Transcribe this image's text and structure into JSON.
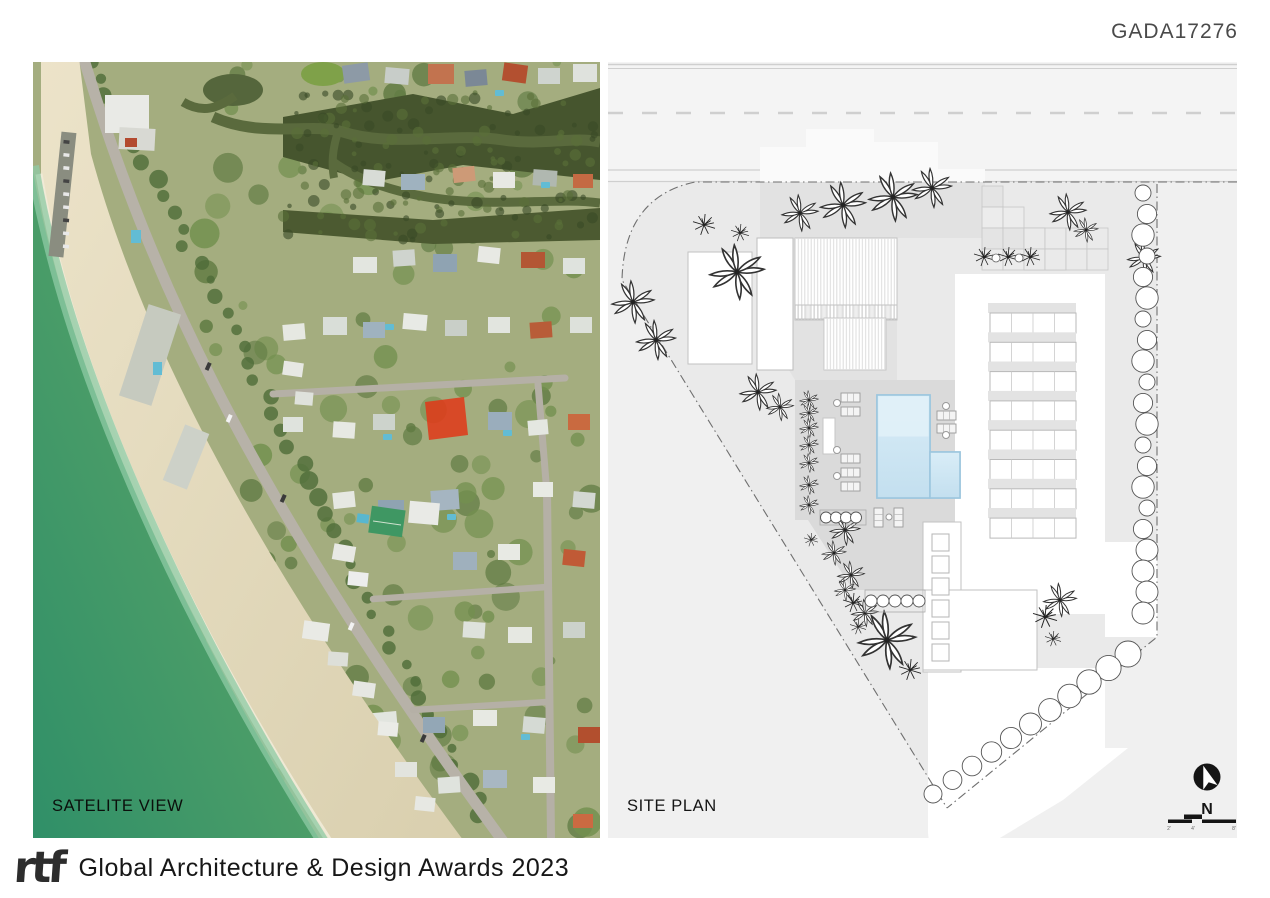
{
  "header": {
    "code": "GADA17276"
  },
  "satellite": {
    "label": "SATELITE VIEW",
    "colors": {
      "ocean_deep": "#2f8f68",
      "ocean_mid": "#4f9f68",
      "ocean_shallow": "#9ed2b2",
      "sand": "#e4dabc",
      "vegetation": "#77914f",
      "mangrove": "#46552e",
      "channel_water": "#5a6a3d",
      "road": "#b7b2a8",
      "site_highlight": "#e23718"
    }
  },
  "site_plan": {
    "label": "SITE PLAN",
    "north_label": "N",
    "scale_labels": [
      "2'",
      "4'",
      "8'"
    ],
    "colors": {
      "background": "#f0f0f0",
      "paving": "#ffffff",
      "deck": "#dadada",
      "pool": "#cfe6f4",
      "pool_edge": "#9cc6de",
      "boundary_line": "#6f6f6f"
    }
  },
  "footer": {
    "logo_text": "rtf",
    "title": "Global Architecture & Design Awards 2023"
  }
}
